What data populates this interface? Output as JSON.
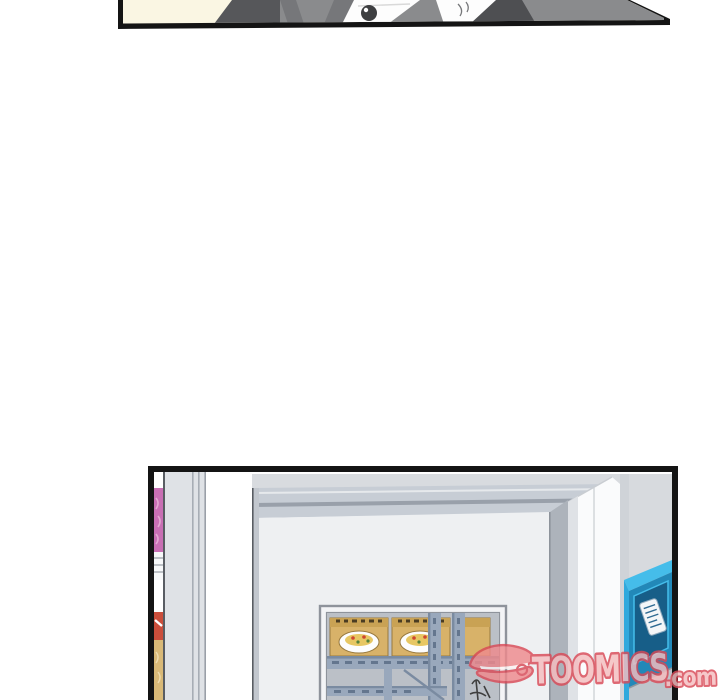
{
  "page": {
    "background": "#ffffff"
  },
  "watermark": {
    "brand": "TOOMICS",
    "suffix": ".com",
    "colors": {
      "fill": "#f5bdbf",
      "stroke": "#d94956",
      "glyph": "#ef8a8d",
      "slit": "#fdf4f4"
    }
  },
  "panel_top": {
    "label": "cropped panel bottom: torso of character in gray suit on cream backdrop",
    "colors": {
      "border": "#141414",
      "backdrop": "#faf6e3",
      "sleeve": "#56575a",
      "jacket": "#8a8b8d",
      "jacket_shade": "#76777a",
      "lapel": "#4e4f52",
      "shirt": "#fdfdfd",
      "shirt_shade": "#d9d9d9",
      "button": "#3e3f41"
    }
  },
  "panel_bottom": {
    "label": "store entrance: snack shelf, doorway with noodle display window, vending machine",
    "colors": {
      "border": "#141414",
      "wall_top": "#d8dbdf",
      "header": "#c7cdd5",
      "header_line": "#99a0aa",
      "interior_wall": "#eef0f2",
      "inner_frame": "#adb3bb",
      "outer_jamb": "#fafbfc",
      "jamb_shade": "#c9cdd2",
      "right_wall": "#d7dade",
      "end_panel": "#dfe2e6",
      "end_panel_edge": "#595d63",
      "end_panel_seam": "#a7adb5",
      "glass": "#bbc0c7",
      "window_frame": "#f3f4f6",
      "window_frame_line": "#8e939b",
      "shelf_steel": "#99a8bc",
      "shelf_steel_dark": "#64768e",
      "shelf_edge": "#7a8ba1",
      "noodle_pack": "#d8b269",
      "noodle_flap": "#c9a254",
      "noodle_outline": "#97793f",
      "noodle_mark": "#4a3c22",
      "bowl": "#fdfdfd",
      "noodles": "#e7c763",
      "garnish_red": "#cf4630",
      "garnish_green": "#55823c",
      "item_pink": "#c96fb4",
      "item_pink_light": "#e3a8d2",
      "item_red": "#cb4e3b",
      "item_tan": "#d9b977",
      "shelf_band": "#f7f8f9",
      "shelf_band_line": "#9aa0a8",
      "machine_top": "#45bdea",
      "machine_edge": "#2fa9dd",
      "machine_face": "#2288b8",
      "machine_panel": "#175e88",
      "machine_panel_edge": "#45bdea",
      "machine_base": "#bec5cb",
      "machine_base_line": "#8f979e",
      "label_white": "#f4f6f8",
      "label_line": "#2f6a92",
      "doodle": "#3f3f3f"
    }
  }
}
